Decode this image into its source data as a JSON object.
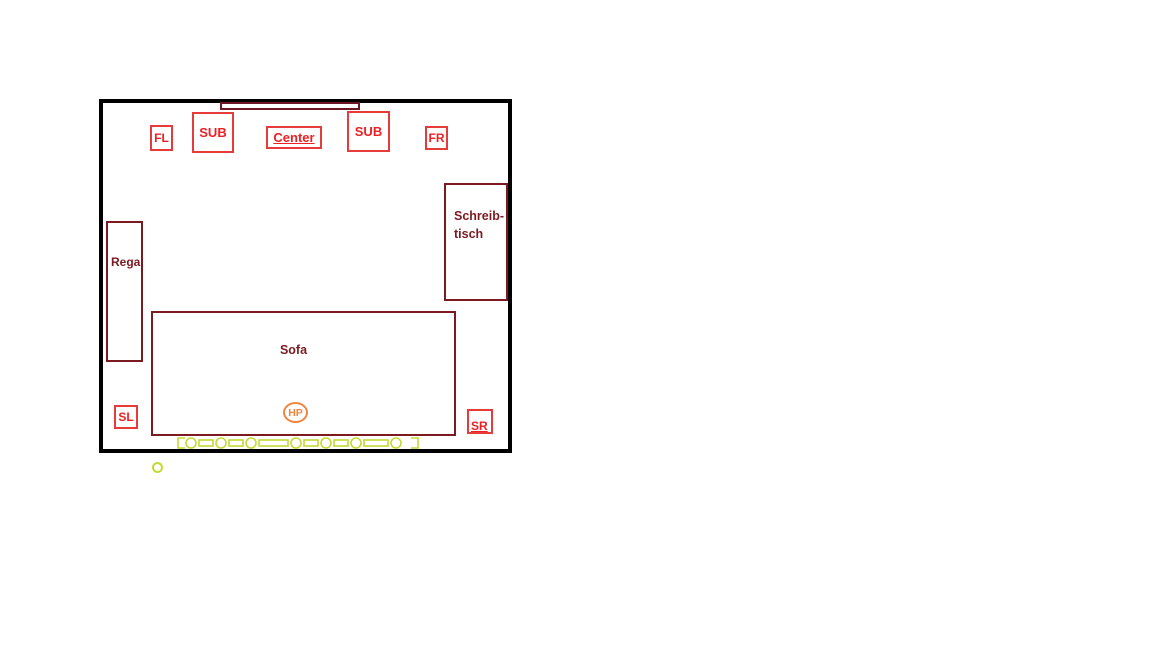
{
  "plan": {
    "tv": {
      "name": "tv-screen"
    },
    "speakers": {
      "front_left": {
        "label": "FL"
      },
      "sub_left": {
        "label": "SUB"
      },
      "center": {
        "label": "Center"
      },
      "sub_right": {
        "label": "SUB"
      },
      "front_right": {
        "label": "FR"
      },
      "surround_left": {
        "label": "SL"
      },
      "surround_right": {
        "label": "SR"
      }
    },
    "furniture": {
      "shelf": {
        "label": "Regal"
      },
      "desk": {
        "label_line1": "Schreib-",
        "label_line2": "tisch"
      },
      "sofa": {
        "label": "Sofa"
      }
    },
    "listening_position": {
      "label": "HP"
    },
    "colors": {
      "wall": "#000000",
      "speaker_red": "#e73b3a",
      "speaker_red_text": "#ed2024",
      "furniture_dark_red": "#7b1b21",
      "tv_dark_red": "#6b1423",
      "radiator_lime": "#c3d935",
      "listening_orange": "#ef8540",
      "background": "#ffffff"
    }
  }
}
